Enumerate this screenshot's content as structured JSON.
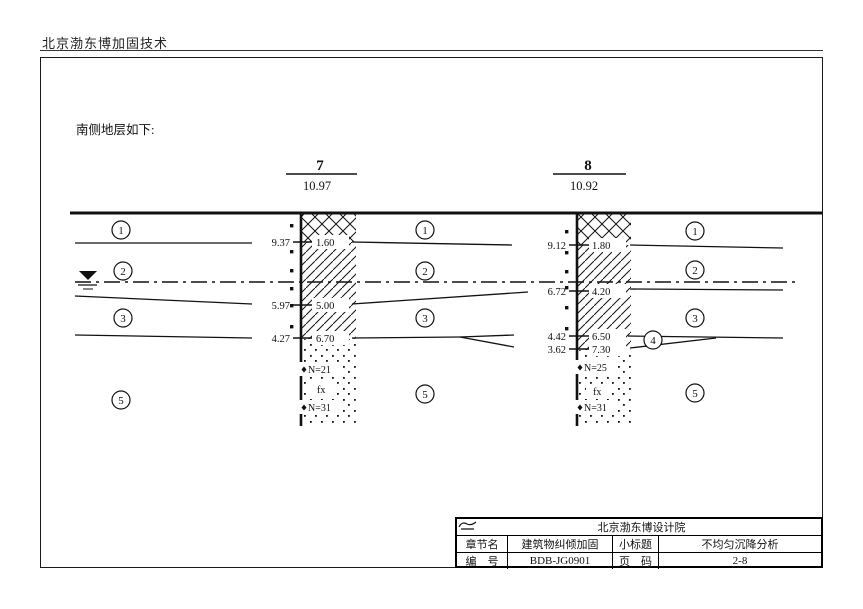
{
  "header_title": "北京渤东博加固技术",
  "intro_text": "南侧地层如下:",
  "cross_section": {
    "layer_labels": [
      "1",
      "2",
      "3",
      "4",
      "5"
    ],
    "boreholes": [
      {
        "id": "7",
        "elevation": "10.97",
        "markers": [
          {
            "left": "9.37",
            "right": "1.60"
          },
          {
            "left": "5.97",
            "right": "5.00"
          },
          {
            "left": "4.27",
            "right": "6.70"
          }
        ],
        "annotations": [
          "N=21",
          "fx",
          "N=31"
        ]
      },
      {
        "id": "8",
        "elevation": "10.92",
        "markers": [
          {
            "left": "9.12",
            "right": "1.80"
          },
          {
            "left": "6.72",
            "right": "4.20"
          },
          {
            "left": "4.42",
            "right": "6.50"
          },
          {
            "left": "3.62",
            "right": "7.30"
          }
        ],
        "annotations": [
          "N=25",
          "fx",
          "N=31"
        ]
      }
    ]
  },
  "title_block": {
    "institute": "北京渤东博设计院",
    "rows": [
      {
        "label_a": "章节名",
        "value_a": "建筑物纠倾加固",
        "label_b": "小标题",
        "value_b": "不均匀沉降分析"
      },
      {
        "label_a": "编　号",
        "value_a": "BDB-JG0901",
        "label_b": "页　码",
        "value_b": "2-8"
      }
    ]
  }
}
